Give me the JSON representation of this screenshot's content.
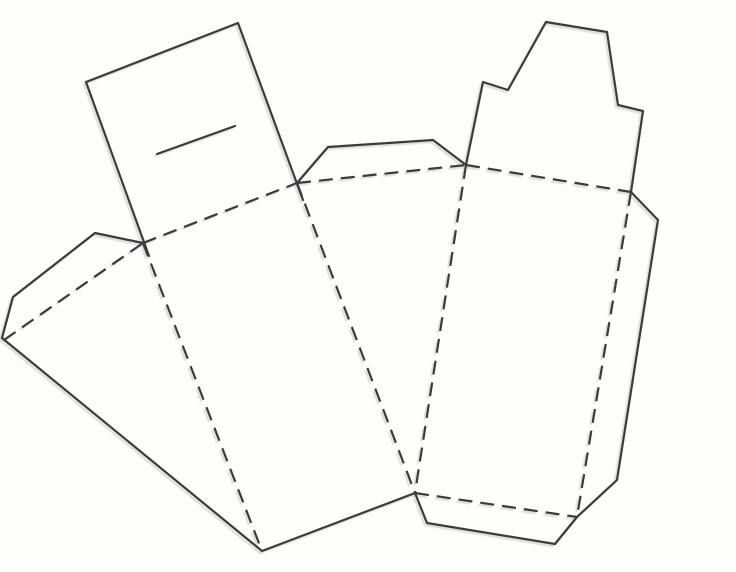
{
  "canvas": {
    "width": 736,
    "height": 572,
    "background": "#fdfdfc",
    "line_color": "#3b3b3b",
    "dash_pattern": "14 8",
    "default_stroke_width": 2.2
  },
  "diagram": {
    "description": "Papercraft cut-and-fold template: solid lines are cut edges, dashed lines are fold lines. Left piece is a wedge (cake-slice) box with a slotted glue tab; right piece is a carton panel with a notched top tab, side flap and bottom flap.",
    "line_styles": {
      "cut": "solid",
      "fold": "dashed"
    },
    "pieces": [
      {
        "name": "wedge-box-piece",
        "lines": [
          {
            "name": "glue-tab-top-edge",
            "style": "cut",
            "points": [
              [
                86,
                82
              ],
              [
                238,
                23
              ]
            ]
          },
          {
            "name": "glue-tab-left-edge",
            "style": "cut",
            "points": [
              [
                86,
                82
              ],
              [
                149,
                256
              ]
            ]
          },
          {
            "name": "glue-tab-right-edge",
            "style": "cut",
            "points": [
              [
                238,
                23
              ],
              [
                303,
                200
              ]
            ]
          },
          {
            "name": "slot-slit",
            "style": "cut",
            "width": 3.2,
            "points": [
              [
                157,
                154
              ],
              [
                235,
                126
              ]
            ]
          },
          {
            "name": "left-side-flap-cut",
            "style": "cut",
            "points": [
              [
                143,
                243
              ],
              [
                95,
                233
              ],
              [
                13,
                297
              ],
              [
                2,
                338
              ]
            ]
          },
          {
            "name": "wedge-left-cut-edge",
            "style": "cut",
            "points": [
              [
                2,
                338
              ],
              [
                262,
                551
              ]
            ]
          },
          {
            "name": "wedge-bottom-cut-edge",
            "style": "cut",
            "points": [
              [
                262,
                551
              ],
              [
                415,
                493
              ]
            ]
          },
          {
            "name": "middle-glue-flap-cut",
            "style": "cut",
            "points": [
              [
                297,
                183
              ],
              [
                328,
                147
              ],
              [
                433,
                140
              ],
              [
                466,
                165
              ]
            ]
          },
          {
            "name": "left-flap-fold",
            "style": "fold",
            "points": [
              [
                4,
                340
              ],
              [
                143,
                243
              ]
            ]
          },
          {
            "name": "top-fold-1",
            "style": "fold",
            "points": [
              [
                143,
                243
              ],
              [
                297,
                183
              ]
            ]
          },
          {
            "name": "top-fold-2",
            "style": "fold",
            "points": [
              [
                297,
                183
              ],
              [
                466,
                165
              ]
            ]
          },
          {
            "name": "top-fold-3",
            "style": "fold",
            "points": [
              [
                466,
                165
              ],
              [
                631,
                192
              ]
            ]
          },
          {
            "name": "wedge-fold-left",
            "style": "fold",
            "points": [
              [
                143,
                243
              ],
              [
                262,
                551
              ]
            ]
          },
          {
            "name": "wedge-fold-right",
            "style": "fold",
            "points": [
              [
                297,
                183
              ],
              [
                415,
                493
              ]
            ]
          }
        ]
      },
      {
        "name": "carton-piece",
        "lines": [
          {
            "name": "notched-top-tab-cut",
            "style": "cut",
            "points": [
              [
                466,
                165
              ],
              [
                483,
                82
              ],
              [
                508,
                90
              ],
              [
                546,
                22
              ],
              [
                607,
                32
              ],
              [
                618,
                105
              ],
              [
                643,
                111
              ],
              [
                631,
                192
              ]
            ]
          },
          {
            "name": "right-side-flap-cut",
            "style": "cut",
            "points": [
              [
                631,
                192
              ],
              [
                658,
                220
              ],
              [
                617,
                480
              ],
              [
                577,
                517
              ]
            ]
          },
          {
            "name": "bottom-flap-cut",
            "style": "cut",
            "points": [
              [
                415,
                493
              ],
              [
                427,
                523
              ],
              [
                555,
                544
              ],
              [
                577,
                517
              ]
            ]
          },
          {
            "name": "left-side-fold",
            "style": "fold",
            "points": [
              [
                466,
                165
              ],
              [
                415,
                493
              ]
            ]
          },
          {
            "name": "right-side-fold",
            "style": "fold",
            "points": [
              [
                631,
                192
              ],
              [
                577,
                517
              ]
            ]
          },
          {
            "name": "bottom-fold",
            "style": "fold",
            "points": [
              [
                415,
                493
              ],
              [
                577,
                517
              ]
            ]
          }
        ]
      }
    ]
  }
}
